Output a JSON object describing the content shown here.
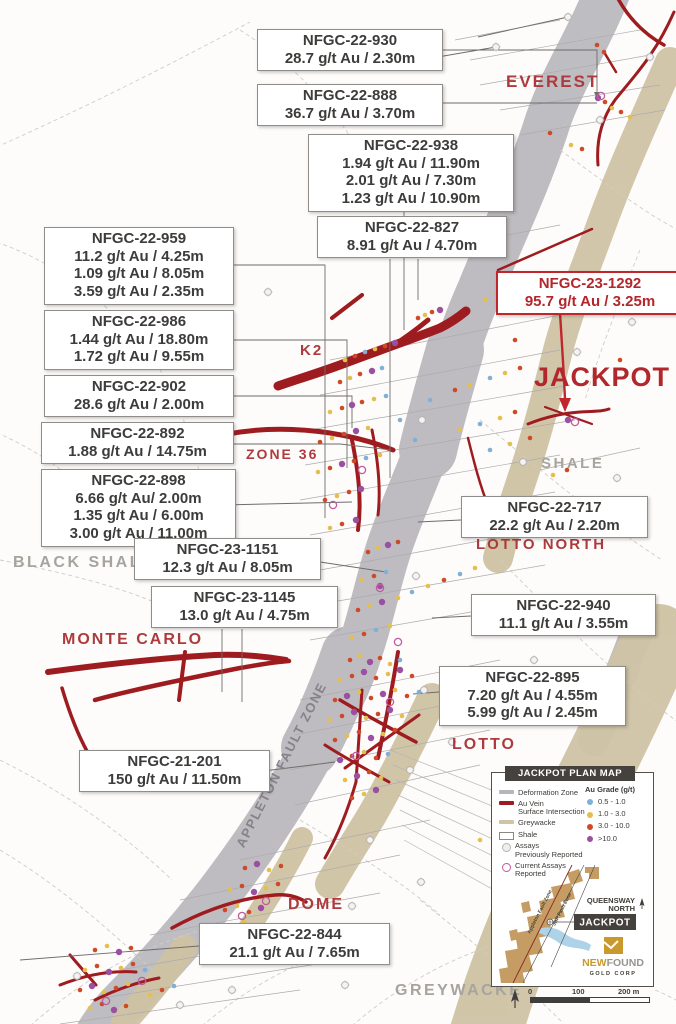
{
  "callouts": [
    {
      "id": "NFGC-22-930",
      "lines": [
        "28.7 g/t Au / 2.30m"
      ],
      "variant": "normal",
      "x": 257,
      "y": 29,
      "w": 172
    },
    {
      "id": "NFGC-22-888",
      "lines": [
        "36.7 g/t Au / 3.70m"
      ],
      "variant": "normal",
      "x": 257,
      "y": 84,
      "w": 172
    },
    {
      "id": "NFGC-22-938",
      "lines": [
        "1.94 g/t Au / 11.90m",
        "2.01 g/t Au / 7.30m",
        "1.23 g/t Au / 10.90m"
      ],
      "variant": "normal",
      "x": 308,
      "y": 134,
      "w": 192
    },
    {
      "id": "NFGC-22-827",
      "lines": [
        "8.91 g/t Au / 4.70m"
      ],
      "variant": "normal",
      "x": 317,
      "y": 216,
      "w": 176
    },
    {
      "id": "NFGC-23-1292",
      "lines": [
        "95.7 g/t Au / 3.25m"
      ],
      "variant": "highlight",
      "x": 496,
      "y": 271,
      "w": 172
    },
    {
      "id": "NFGC-22-959",
      "lines": [
        "11.2 g/t Au / 4.25m",
        "1.09 g/t Au / 8.05m",
        "3.59 g/t Au / 2.35m"
      ],
      "variant": "normal",
      "x": 44,
      "y": 227,
      "w": 176
    },
    {
      "id": "NFGC-22-986",
      "lines": [
        "1.44 g/t Au / 18.80m",
        "1.72 g/t Au / 9.55m"
      ],
      "variant": "normal",
      "x": 44,
      "y": 310,
      "w": 176
    },
    {
      "id": "NFGC-22-902",
      "lines": [
        "28.6 g/t Au / 2.00m"
      ],
      "variant": "normal",
      "x": 44,
      "y": 375,
      "w": 176
    },
    {
      "id": "NFGC-22-892",
      "lines": [
        "1.88 g/t Au / 14.75m"
      ],
      "variant": "normal",
      "x": 41,
      "y": 422,
      "w": 179
    },
    {
      "id": "NFGC-22-898",
      "lines": [
        "6.66 g/t Au/ 2.00m",
        "1.35 g/t Au / 6.00m",
        "3.00 g/t Au / 11.00m"
      ],
      "variant": "normal",
      "x": 41,
      "y": 469,
      "w": 181
    },
    {
      "id": "NFGC-23-1151",
      "lines": [
        "12.3 g/t Au / 8.05m"
      ],
      "variant": "normal",
      "x": 134,
      "y": 538,
      "w": 173
    },
    {
      "id": "NFGC-23-1145",
      "lines": [
        "13.0 g/t Au / 4.75m"
      ],
      "variant": "normal",
      "x": 151,
      "y": 586,
      "w": 173
    },
    {
      "id": "NFGC-22-717",
      "lines": [
        "22.2 g/t Au / 2.20m"
      ],
      "variant": "normal",
      "x": 461,
      "y": 496,
      "w": 173
    },
    {
      "id": "NFGC-22-940",
      "lines": [
        "11.1 g/t Au / 3.55m"
      ],
      "variant": "normal",
      "x": 471,
      "y": 594,
      "w": 171
    },
    {
      "id": "NFGC-22-895",
      "lines": [
        "7.20 g/t Au / 4.55m",
        "5.99 g/t Au / 2.45m"
      ],
      "variant": "normal",
      "x": 439,
      "y": 666,
      "w": 173
    },
    {
      "id": "NFGC-21-201",
      "lines": [
        "150 g/t Au / 11.50m"
      ],
      "variant": "normal",
      "x": 79,
      "y": 750,
      "w": 177
    },
    {
      "id": "NFGC-22-844",
      "lines": [
        "21.1 g/t Au / 7.65m"
      ],
      "variant": "normal",
      "x": 199,
      "y": 923,
      "w": 177
    }
  ],
  "zone_labels": [
    {
      "text": "EVEREST",
      "kind": "red",
      "x": 506,
      "y": 72,
      "size": 17
    },
    {
      "text": "K2",
      "kind": "red",
      "x": 300,
      "y": 342,
      "size": 15
    },
    {
      "text": "JACKPOT",
      "kind": "big",
      "x": 534,
      "y": 362,
      "size": 27
    },
    {
      "text": "ZONE 36",
      "kind": "red",
      "x": 246,
      "y": 446,
      "size": 14
    },
    {
      "text": "SHALE",
      "kind": "gray",
      "x": 541,
      "y": 455,
      "size": 15
    },
    {
      "text": "LOTTO NORTH",
      "kind": "red",
      "x": 476,
      "y": 536,
      "size": 15
    },
    {
      "text": "BLACK SHALE",
      "kind": "gray",
      "x": 13,
      "y": 554,
      "size": 16
    },
    {
      "text": "MONTE CARLO",
      "kind": "red",
      "x": 62,
      "y": 631,
      "size": 16
    },
    {
      "text": "LOTTO",
      "kind": "red",
      "x": 452,
      "y": 736,
      "size": 16
    },
    {
      "text": "APPLETON FAULT ZONE",
      "kind": "rot",
      "x": 233,
      "y": 843,
      "size": 13,
      "rotate": -63
    },
    {
      "text": "DOME",
      "kind": "red",
      "x": 288,
      "y": 896,
      "size": 16
    },
    {
      "text": "GREYWACKE",
      "kind": "gray",
      "x": 395,
      "y": 982,
      "size": 16
    }
  ],
  "legend": {
    "title": "JACKPOT PLAN MAP",
    "line_items": [
      {
        "label": [
          "Deformation Zone"
        ],
        "swatch": "deformation",
        "color": "#b7b5ba"
      },
      {
        "label": [
          "Au Vein",
          "Surface Intersection"
        ],
        "swatch": "vein",
        "color": "#9e1c20"
      },
      {
        "label": [
          "Greywacke"
        ],
        "swatch": "greywacke",
        "color": "#d0c4a6"
      },
      {
        "label": [
          "Shale"
        ],
        "swatch": "shale",
        "color": "#ffffff"
      },
      {
        "label": [
          "Assays",
          "Previously Reported"
        ],
        "swatch": "assay-prev",
        "color": "#b5b4b2"
      },
      {
        "label": [
          "Current Assays Reported"
        ],
        "swatch": "assay-current",
        "color": "#c25b9d"
      }
    ],
    "grade_title": "Au Grade (g/t)",
    "grades": [
      {
        "label": "0.5 - 1.0",
        "color": "#7fb0d8"
      },
      {
        "label": "1.0 - 3.0",
        "color": "#e4bf4d"
      },
      {
        "label": "3.0 - 10.0",
        "color": "#ce4a27"
      },
      {
        "label": ">10.0",
        "color": "#9b4fa1"
      }
    ]
  },
  "inset": {
    "region_label_line1": "QUEENSWAY",
    "region_label_line2": "NORTH",
    "site_label": "JACKPOT",
    "fault_label_1": "Appleton Fault Zone",
    "fault_label_2": "JBP Fault Zone",
    "brand_new": "NEW",
    "brand_found": "FOUND",
    "brand_sub": "GOLD CORP"
  },
  "scalebar": {
    "labels": [
      "0",
      "100",
      "200 m"
    ]
  },
  "colors": {
    "accent_red": "#b1272c",
    "vein_red": "#9e1c20",
    "deformation_gray": "#b7b5ba",
    "greywacke_tan": "#cfc3a4",
    "highlight_box_red": "#c0272c"
  }
}
